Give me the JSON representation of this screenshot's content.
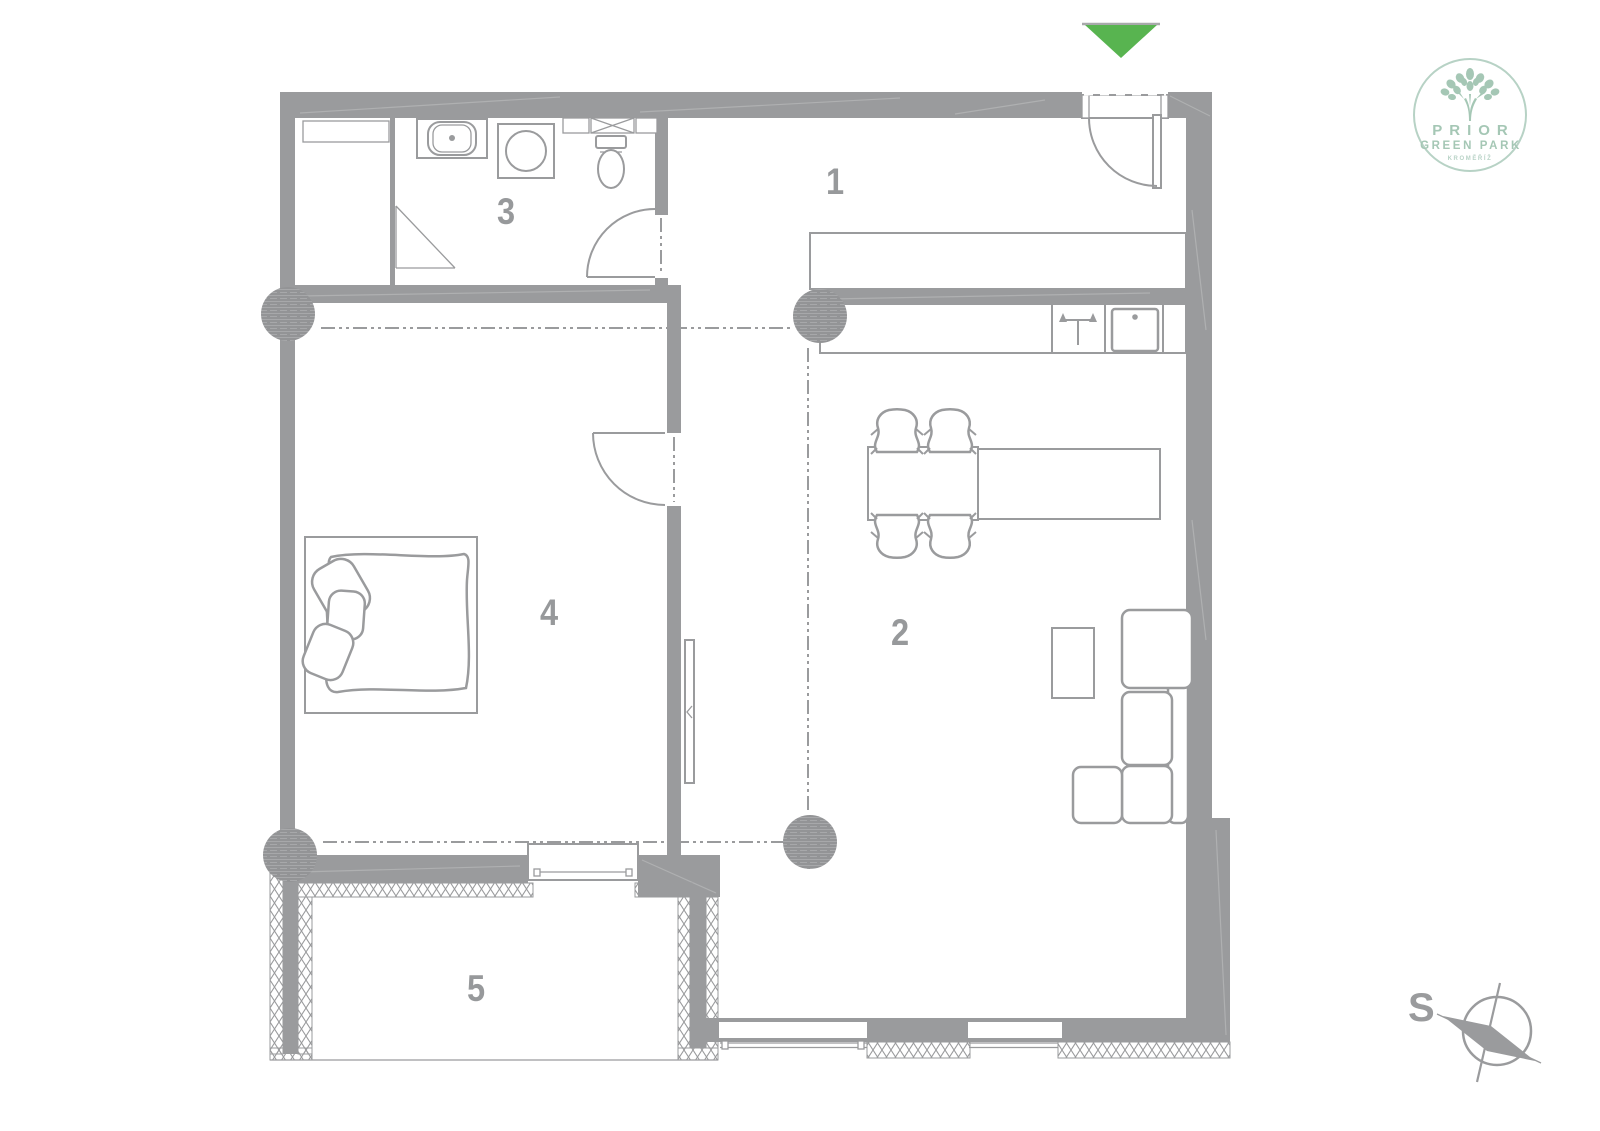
{
  "colors": {
    "plan": "#9a9b9d",
    "plan-light": "#b4b5b7",
    "arrow-green": "#58b450",
    "logo-green": "#a5c7b5"
  },
  "floor_plan": {
    "room_labels": [
      "1",
      "2",
      "3",
      "4",
      "5"
    ],
    "entrance_marker_icon": "entrance-arrow-icon",
    "fixtures": [
      "wash-basin-icon",
      "washing-machine-icon",
      "toilet-icon",
      "duct-shaft-icon",
      "stove-icon",
      "kitchen-sink-icon",
      "radiator-icon"
    ]
  },
  "logo": {
    "title": "PRIOR",
    "subtitle": "GREEN PARK",
    "city": "KROMĚŘÍŽ",
    "tree_icon": "tree-icon"
  },
  "compass": {
    "south_label": "S",
    "rose_icon": "compass-rose-icon"
  }
}
